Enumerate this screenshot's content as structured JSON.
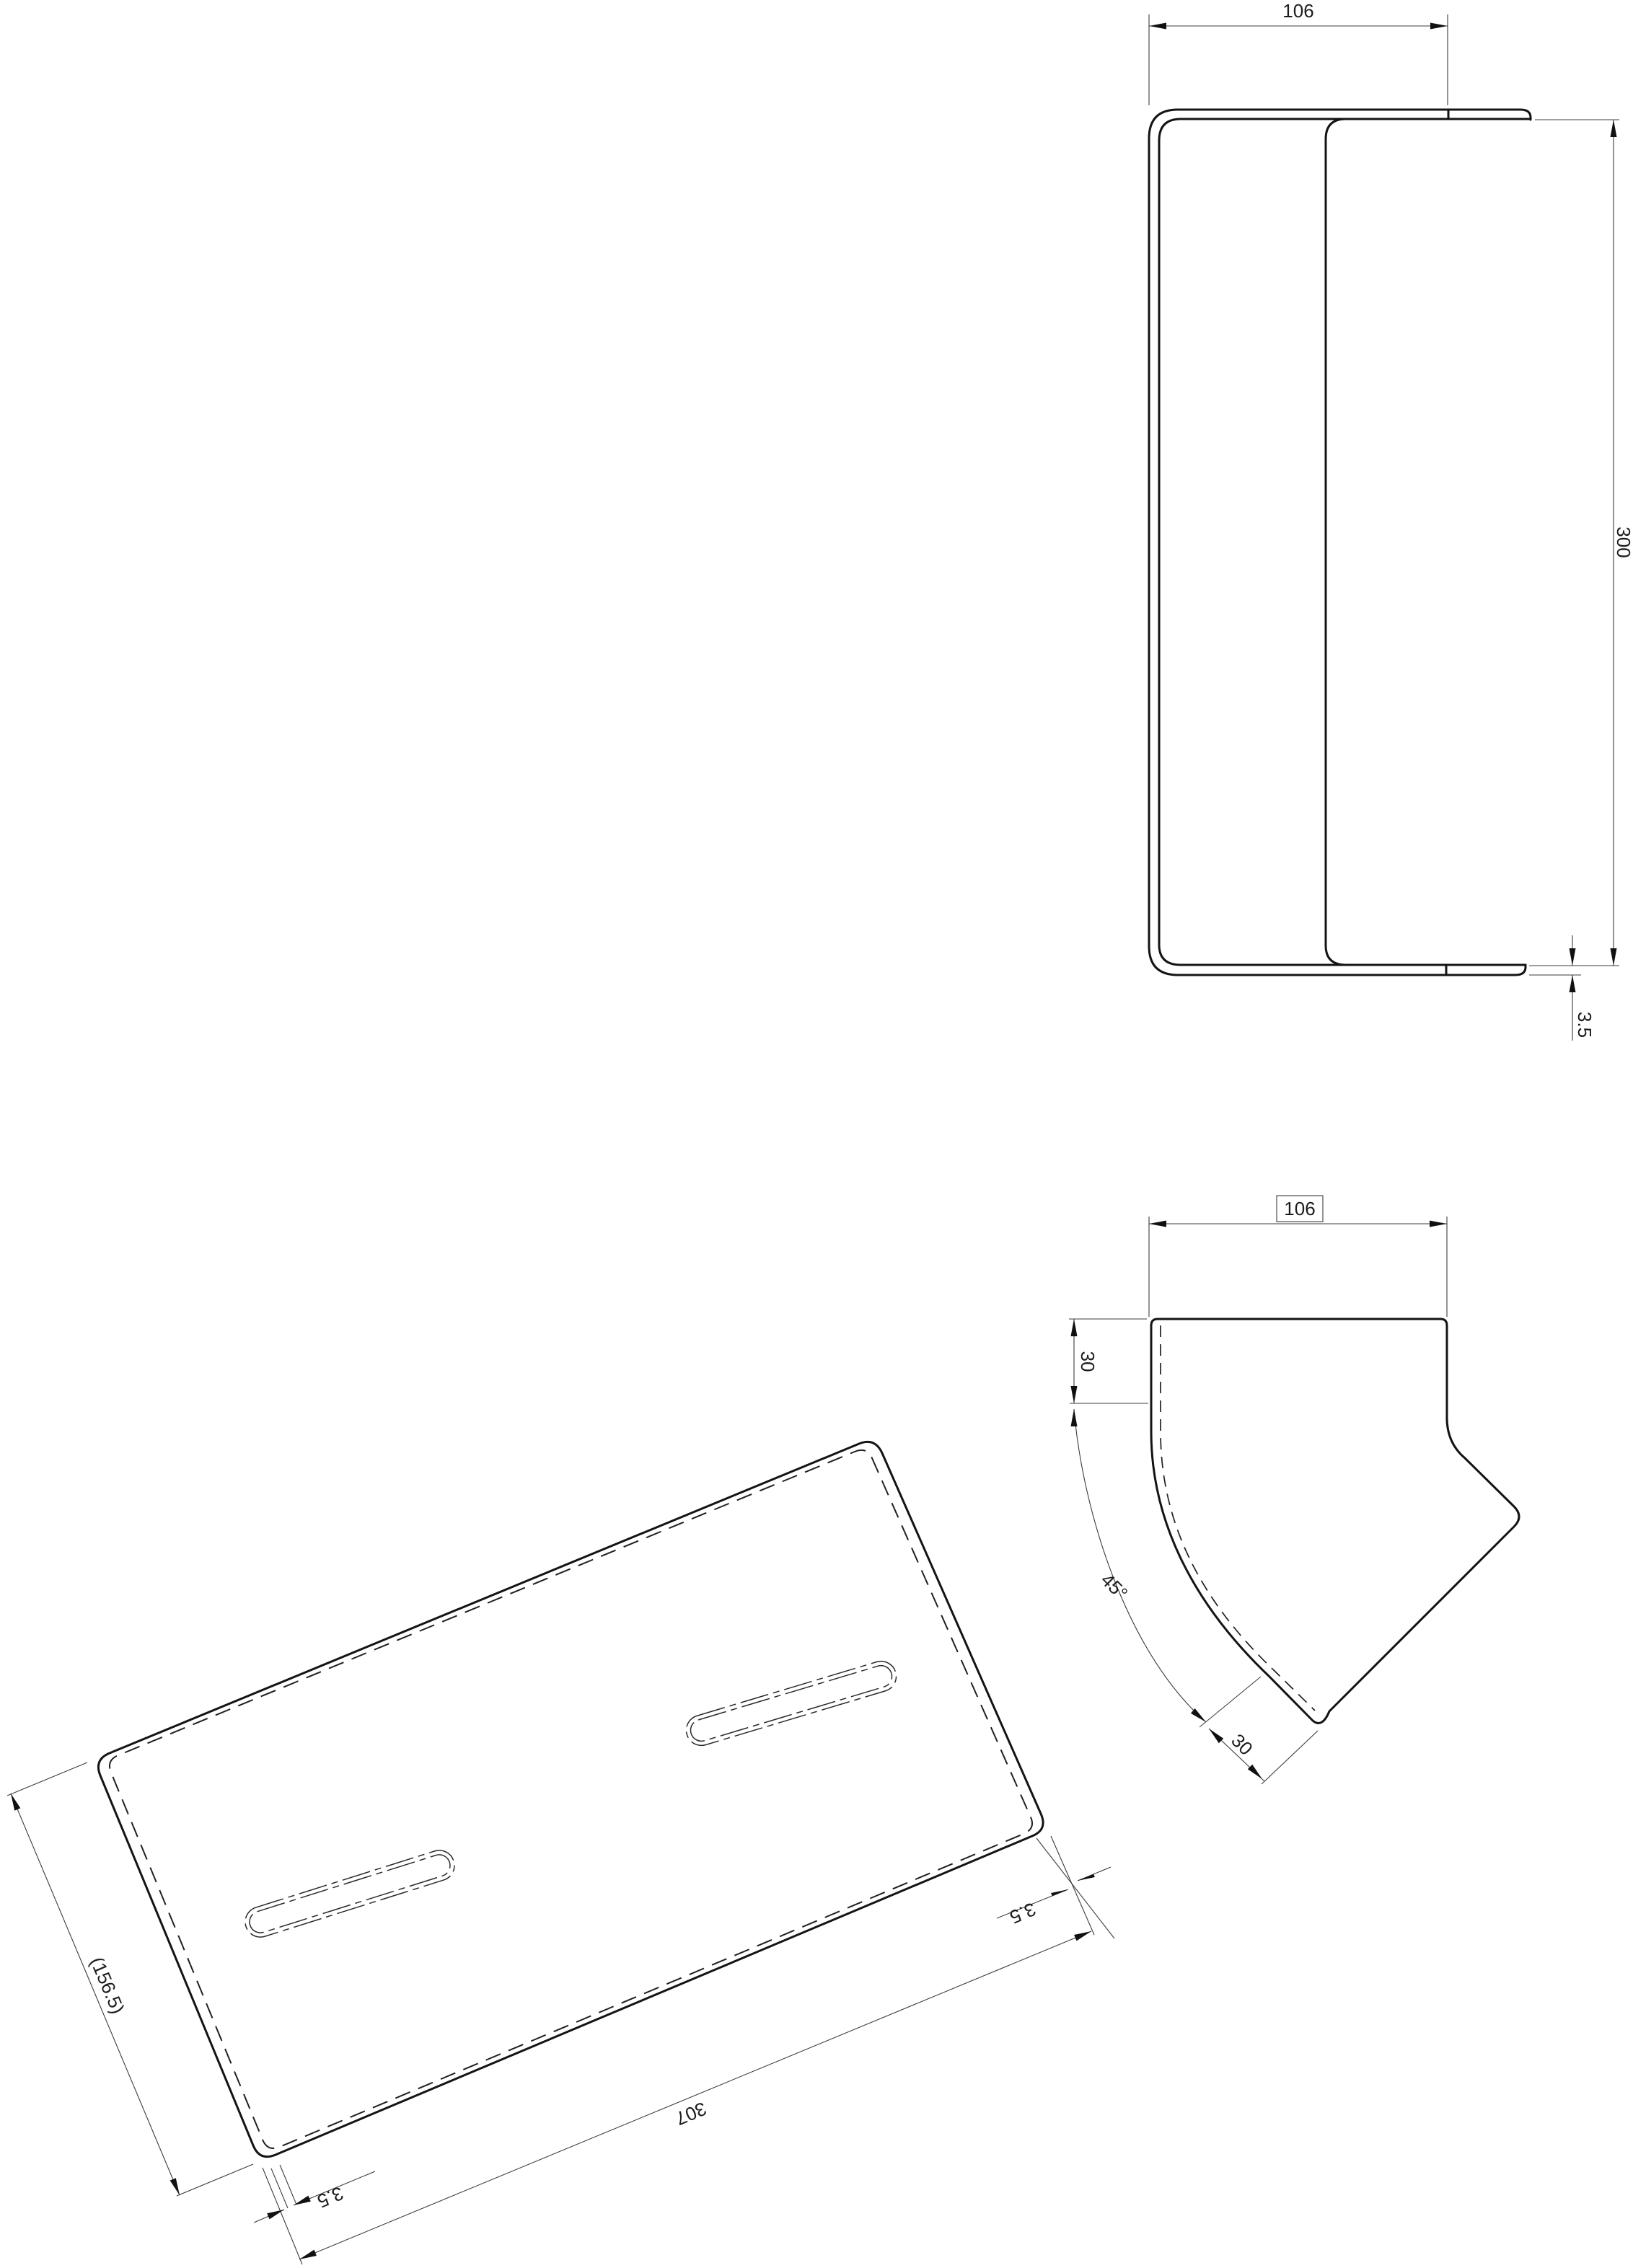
{
  "drawing": {
    "type": "cad-multiview-technical-drawing",
    "background": "#ffffff",
    "line_color": "#141414",
    "part": "bent sheet-metal plate with two slots",
    "labels": {
      "front": {
        "width": "106",
        "height": "300",
        "thickness": "3.5"
      },
      "side": {
        "width": "106",
        "top_offset": "30",
        "bend_angle": "45°",
        "flange_length": "30"
      },
      "flat": {
        "width_ref": "(156.5)",
        "length": "307",
        "thickness_left": "3.5",
        "thickness_right": "3.5"
      }
    }
  }
}
